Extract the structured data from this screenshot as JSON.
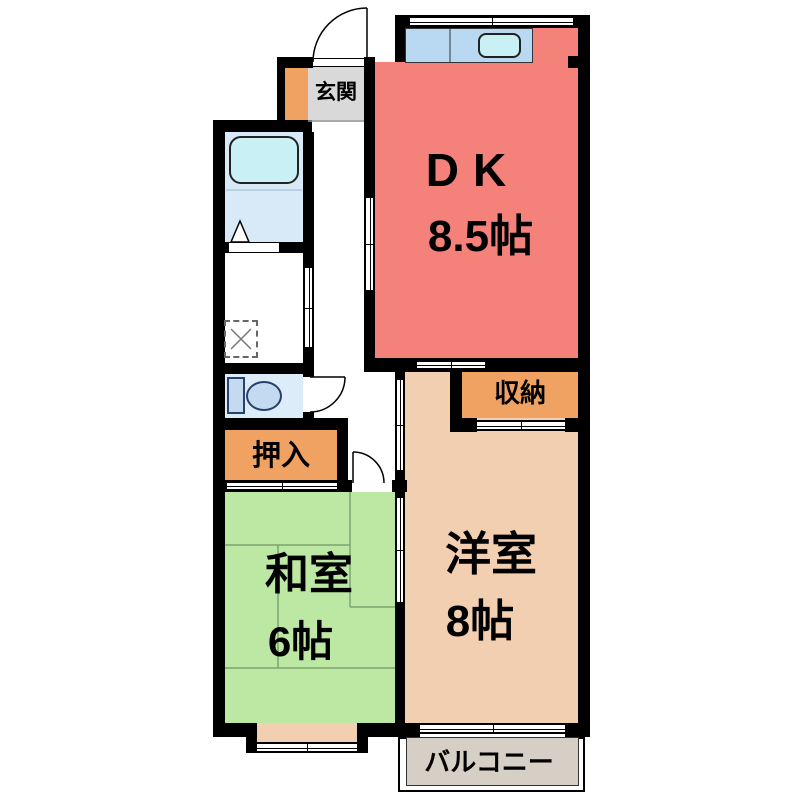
{
  "floorplan": {
    "rooms": {
      "dk": {
        "label": "DK",
        "size": "8.5帖",
        "color": "#f5817b"
      },
      "genkan": {
        "label": "玄関",
        "color": "#d9d9d9"
      },
      "washitsu": {
        "label": "和室",
        "size": "6帖",
        "color": "#bce8a3"
      },
      "youshitsu": {
        "label": "洋室",
        "size": "8帖",
        "color": "#f3cfb2"
      },
      "oshiire": {
        "label": "押入",
        "color": "#f0a262"
      },
      "shuunou": {
        "label": "収納",
        "color": "#f0a262"
      },
      "balcony": {
        "label": "バルコニー",
        "color": "#d6cfc5"
      }
    },
    "fixtures": {
      "bathtub": "bathtub",
      "toilet": "toilet",
      "kitchen_sink": "kitchen-sink",
      "kitchen_counter": "kitchen-counter",
      "washer_pan": "washing-machine-pan",
      "shoe_cabinet": "shoe-cabinet"
    },
    "colors": {
      "wall": "#000000",
      "counter_blue": "#b9d8f1",
      "sink_cyan": "#c8f0f5",
      "bath_blue": "#d8eaf8",
      "toilet_blue": "#dcecf9",
      "fixture_blue": "#c3daf0",
      "tatami_line": "#7ca46f",
      "balcony_gray": "#d6cfc5"
    }
  }
}
